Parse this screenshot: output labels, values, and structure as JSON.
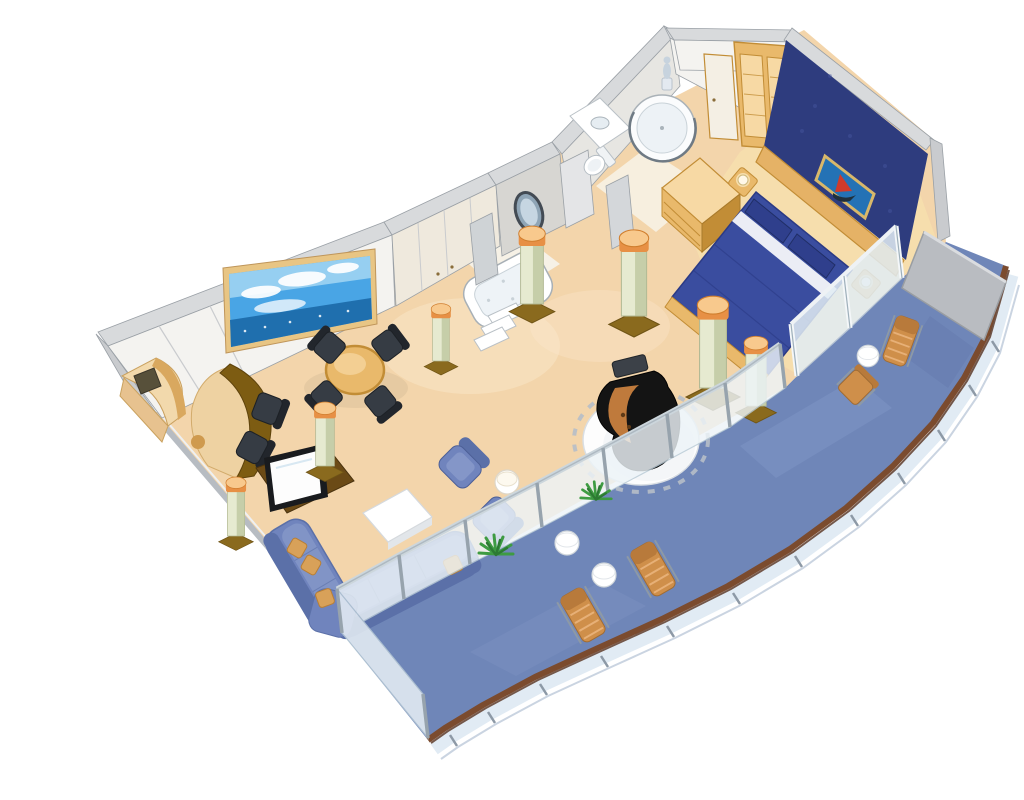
{
  "canvas": {
    "width": 1024,
    "height": 768,
    "background": "#ffffff"
  },
  "scene": {
    "type": "isometric-cutaway-floor-plan",
    "subject": "cruise-ship-suite-floor-plan",
    "areas": [
      "living-room",
      "dining-area",
      "wet-bar",
      "hallway",
      "bathroom",
      "shower-room",
      "bedroom",
      "wraparound-balcony"
    ],
    "furniture_inventory": [
      {
        "name": "sea-view-mural",
        "count": 1
      },
      {
        "name": "corner-desk",
        "count": 1
      },
      {
        "name": "wet-bar-counter",
        "count": 1
      },
      {
        "name": "bar-stool",
        "count": 2
      },
      {
        "name": "dining-table",
        "count": 1
      },
      {
        "name": "dining-chair",
        "count": 4
      },
      {
        "name": "television",
        "count": 1
      },
      {
        "name": "sectional-sofa",
        "count": 1
      },
      {
        "name": "throw-pillow",
        "count": 4
      },
      {
        "name": "coffee-table",
        "count": 1
      },
      {
        "name": "armchair",
        "count": 2
      },
      {
        "name": "side-table",
        "count": 1
      },
      {
        "name": "grand-piano",
        "count": 1
      },
      {
        "name": "piano-bench",
        "count": 1
      },
      {
        "name": "marble-column",
        "count": 7
      },
      {
        "name": "whirlpool-tub",
        "count": 1
      },
      {
        "name": "toilet",
        "count": 1
      },
      {
        "name": "vanity-sink",
        "count": 1
      },
      {
        "name": "circular-shower",
        "count": 1
      },
      {
        "name": "statue",
        "count": 1
      },
      {
        "name": "oval-mirror",
        "count": 1
      },
      {
        "name": "double-bed",
        "count": 1
      },
      {
        "name": "bed-pillow",
        "count": 2
      },
      {
        "name": "nightstand",
        "count": 2
      },
      {
        "name": "wall-painting",
        "count": 1
      },
      {
        "name": "closet-cabinet",
        "count": 1
      },
      {
        "name": "dresser",
        "count": 1
      },
      {
        "name": "potted-plant",
        "count": 2
      },
      {
        "name": "lounge-chair",
        "count": 3
      },
      {
        "name": "deck-chair",
        "count": 1
      },
      {
        "name": "drum-table",
        "count": 3
      },
      {
        "name": "privacy-divider",
        "count": 1
      },
      {
        "name": "glass-balustrade-panel",
        "count": 10
      }
    ]
  },
  "palette": {
    "floor": "#f3d5ab",
    "floor_light": "#fbe8cd",
    "bedroom_floor": "#f6dfad",
    "deck": "#6f86b8",
    "deck_dark": "#5a6fa3",
    "deck_light": "#8ca1cf",
    "rail_wood": "#7b4b2e",
    "rail_wood_dark": "#55301d",
    "rail_glass": "#dce8f2",
    "stanchion": "#8d99a6",
    "glass_fill": "#edf4f8",
    "glass_edge": "#b9cbd6",
    "glass_post": "#97a3ad",
    "glass_rail": "#ccd6dc",
    "wall_face": "#f4f3f0",
    "wall_face2": "#e7e6e2",
    "wall_cream": "#efe9dd",
    "wall_top": "#d8dadc",
    "wall_gray": "#c9cbce",
    "wall_line": "#9aa0a6",
    "accent_wall": "#2e3c7e",
    "accent_light": "#4a5aa5",
    "headboard": "#e5b266",
    "wood": "#e9b96b",
    "wood_dark": "#c28d36",
    "wood_light": "#f7d9a4",
    "counter": "#7d5c12",
    "cream": "#f6e8c8",
    "chair_dark": "#363c44",
    "chair_darker": "#22262c",
    "sofa": "#7084bd",
    "sofa_dark": "#5b70a8",
    "sofa_light": "#8496c8",
    "pillow_gold": "#d8a159",
    "bed_spread": "#3a4d9f",
    "bed_dark": "#2b3a85",
    "bed_pillow": "#2f3f8c",
    "piano": "#141414",
    "piano_gray": "#3c4148",
    "piano_interior": "#c8803e",
    "painting_bg": "#2472b5",
    "painting_sail": "#cf3b2a",
    "mural_sky": "#49a5e5",
    "mural_sky_light": "#9fd4f2",
    "mural_sea": "#1f6fae",
    "mural_frame": "#e8c584",
    "column_body": "#e6ead0",
    "column_shade": "#c2cba4",
    "column_cap": "#e79045",
    "column_cap_light": "#f8c98d",
    "column_base": "#8a6a1e",
    "plant": "#3e9b42",
    "plant_dark": "#2d7a33",
    "fixture_line": "#a8b0b6",
    "statue": "#c7d3de",
    "divider": "#b9bcc1",
    "tv_frame": "#191b1e",
    "tv_screen": "#fdfdfd",
    "lamp": "#fff8e8",
    "lounge_wood": "#cf8f4a",
    "lounge_wood_dark": "#b87a3b",
    "lounge_slat": "#e7b077"
  }
}
